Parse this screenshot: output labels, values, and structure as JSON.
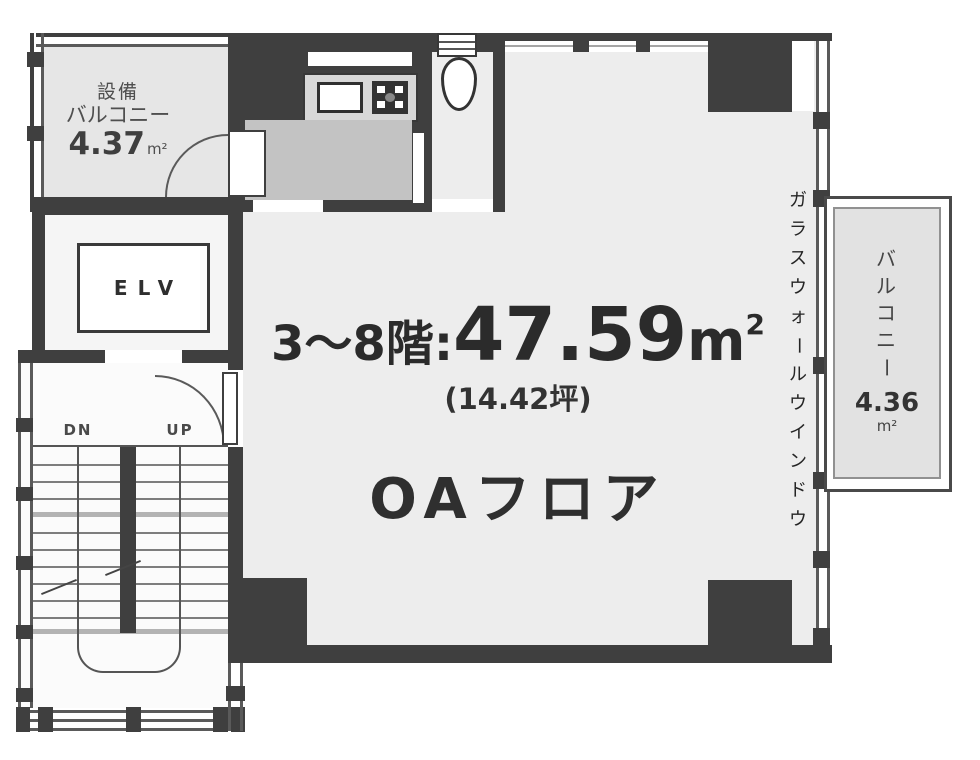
{
  "colors": {
    "wall": "#3f3f3f",
    "room_fill": "#ededed",
    "kitchen_area_fill": "#c3c3c3",
    "counter_fill": "#d8d8d8",
    "balcony_fill": "#e6e6e6"
  },
  "main_room": {
    "title_prefix": "3〜8階:",
    "area_value": "47.59",
    "area_unit": "m",
    "area_unit_sup": "2",
    "subtitle": "(14.42坪)",
    "floor_label": "OAフロア"
  },
  "left_balcony": {
    "name_line1": "設備",
    "name_line2": "バルコニー",
    "area_value": "4.37",
    "area_unit": "m²"
  },
  "right_balcony": {
    "name": "バルコニー",
    "area_value": "4.36",
    "area_unit": "m²"
  },
  "glass_wall": {
    "label": "ガラスウォールウインドウ"
  },
  "elevator": {
    "label": "ELV"
  },
  "stairs": {
    "down_label": "DN",
    "up_label": "UP"
  }
}
